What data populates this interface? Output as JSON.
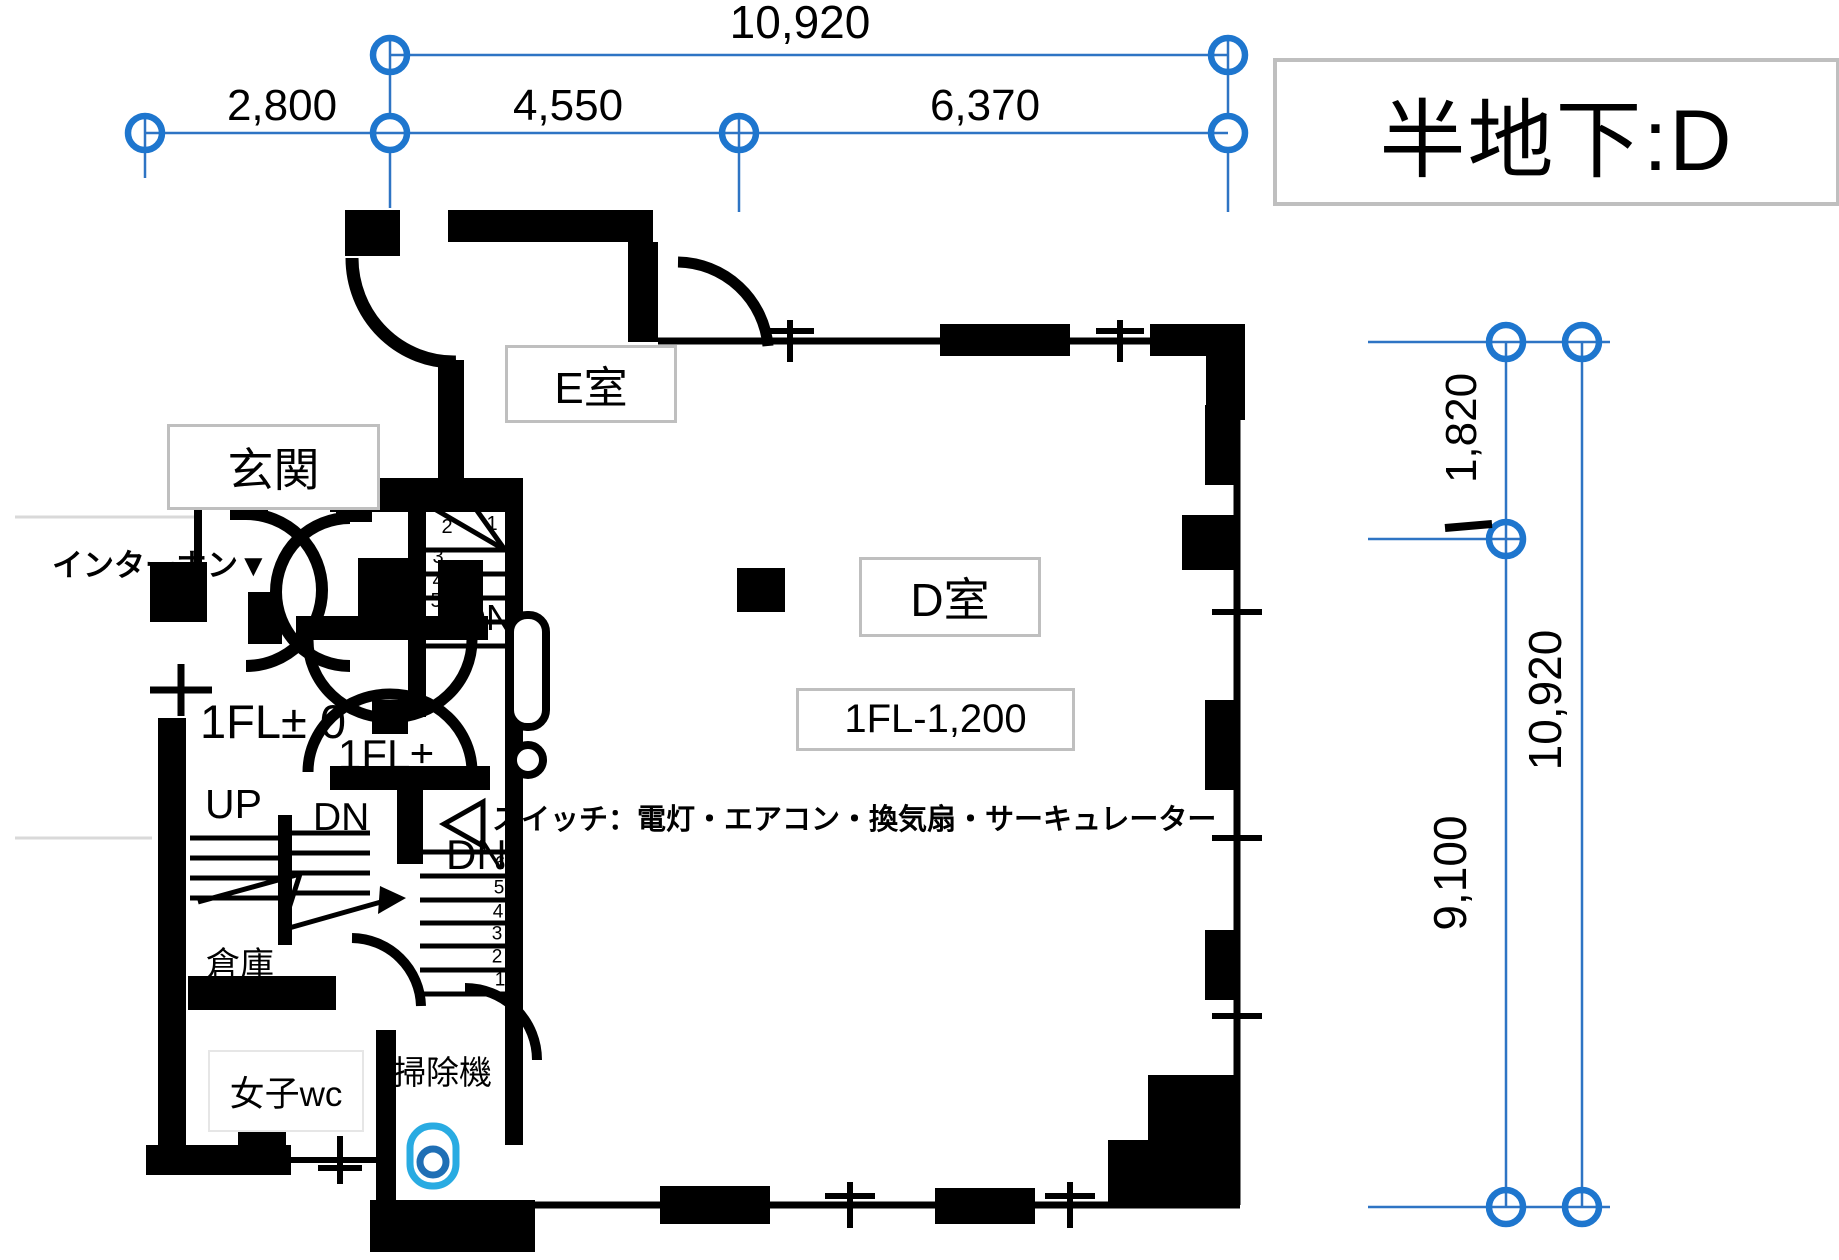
{
  "title": {
    "text": "半地下:D"
  },
  "dimensions": {
    "top": {
      "overall": "10,920",
      "segments": [
        "2,800",
        "4,550",
        "6,370"
      ]
    },
    "right": {
      "upper": "1,820",
      "inner_lower": "9,100",
      "outer_overall": "10,920"
    }
  },
  "rooms": {
    "e": "E室",
    "entrance": "玄関",
    "d": "D室",
    "d_floor_level": "1FL-1,200",
    "wc": "女子wc",
    "cleaner": "掃除機",
    "storage": "倉庫"
  },
  "annotations": {
    "intercom": "インターホン▼",
    "floor_level_entrance": "1FL± 0",
    "floor_level_vestibule": "1FL±",
    "up": "UP",
    "dn_upper": "DN",
    "dn_mid": "DN",
    "dn_lower": "DN",
    "switch_note": "スイッチ：電灯・エアコン・換気扇・サーキュレーター"
  },
  "stairs": {
    "upper_numbers": [
      "1",
      "2",
      "3",
      "4",
      "5",
      "6"
    ],
    "lower_numbers": [
      "6",
      "5",
      "4",
      "3",
      "2",
      "1"
    ]
  },
  "colors": {
    "dimension_blue": "#2E74C4",
    "grid_circle_blue": "#1E76CE",
    "vacuum_outer_blue": "#29ABE2",
    "vacuum_inner_blue": "#1F6FB5",
    "label_box_border": "#BFBFBF",
    "wall_black": "#000000"
  }
}
